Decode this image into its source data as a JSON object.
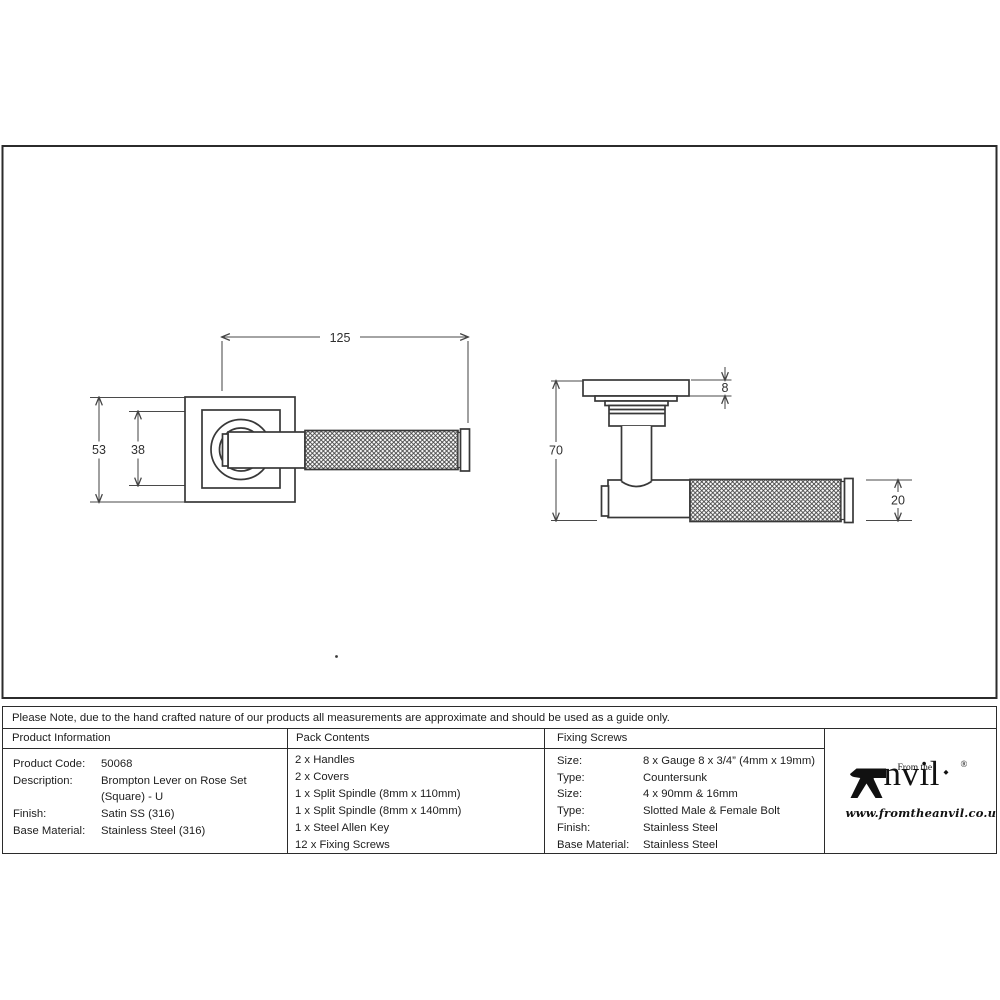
{
  "drawing": {
    "front_view": {
      "width_mm": "125",
      "rose_size_mm": "53",
      "inner_rose_mm": "38"
    },
    "side_view": {
      "rose_depth_mm": "8",
      "projection_mm": "70",
      "grip_diameter_mm": "20"
    }
  },
  "note": "Please Note, due to the hand crafted nature of our products all measurements are approximate and should be used as a guide only.",
  "table": {
    "product_information": {
      "header": "Product Information",
      "rows": [
        {
          "label": "Product Code:",
          "value": "50068"
        },
        {
          "label": "Description:",
          "value": "Brompton Lever on Rose Set"
        },
        {
          "label": "",
          "value": "(Square) - U"
        },
        {
          "label": "Finish:",
          "value": "Satin SS (316)"
        },
        {
          "label": "Base Material:",
          "value": "Stainless Steel (316)"
        }
      ]
    },
    "pack_contents": {
      "header": "Pack Contents",
      "items": [
        "2 x Handles",
        "2 x Covers",
        "1 x Split Spindle (8mm x 110mm)",
        "1 x Split Spindle (8mm x 140mm)",
        "1 x Steel Allen Key",
        "12 x Fixing Screws"
      ]
    },
    "fixing_screws": {
      "header": "Fixing Screws",
      "rows": [
        {
          "label": "Size:",
          "value": "8 x Gauge 8 x 3/4” (4mm x 19mm)"
        },
        {
          "label": "Type:",
          "value": "Countersunk"
        },
        {
          "label": "Size:",
          "value": "4 x 90mm & 16mm"
        },
        {
          "label": "Type:",
          "value": "Slotted Male & Female Bolt"
        },
        {
          "label": "Finish:",
          "value": "Stainless Steel"
        },
        {
          "label": "Base Material:",
          "value": "Stainless Steel"
        }
      ]
    }
  },
  "logo": {
    "prefix": "From the",
    "name_suffix": "nvil",
    "registered": "®",
    "diamond": "◆",
    "website": "www.fromtheanvil.co.uk"
  }
}
